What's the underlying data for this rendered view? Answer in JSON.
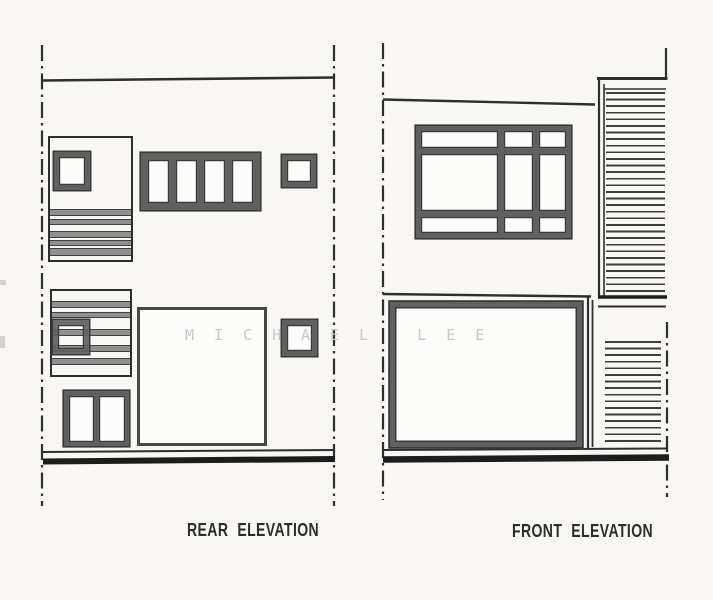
{
  "drawing": {
    "watermark": "MICHAEL LEE",
    "panels": [
      {
        "id": "rear",
        "label": "REAR ELEVATION"
      },
      {
        "id": "front",
        "label": "FRONT ELEVATION"
      }
    ]
  },
  "colors": {
    "background": "#f8f7f4",
    "line": "#2e2e2e",
    "frame": "#606060",
    "frame_outline": "#3a3a3a",
    "stripe": "#3e3e3e",
    "band": "#909090",
    "ground": "#1d1d1d",
    "pane": "#fcfcfb",
    "watermark": "#c9c9c9",
    "label_text": "#2d2d2d"
  }
}
